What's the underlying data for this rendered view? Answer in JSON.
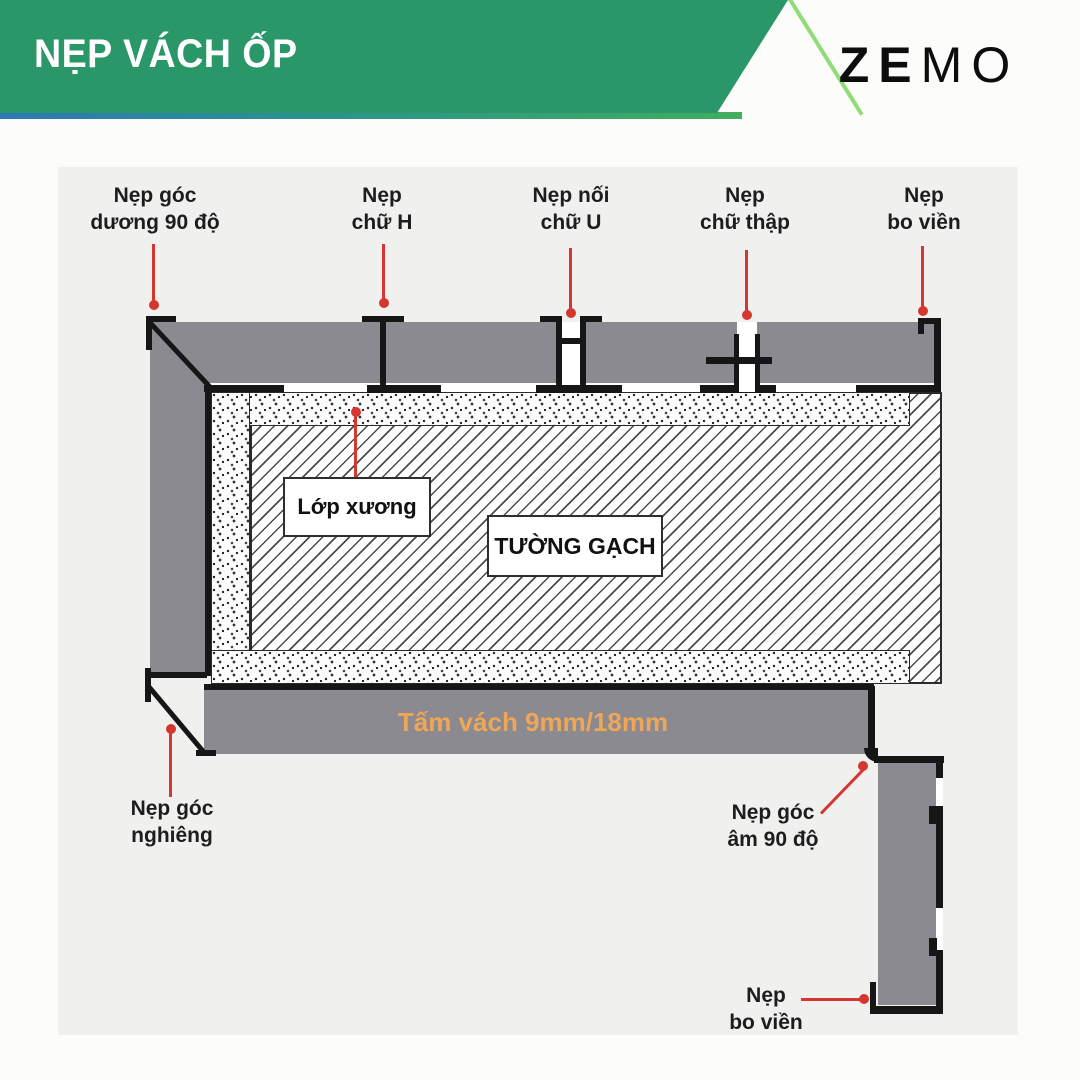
{
  "header": {
    "title": "NẸP VÁCH ỐP",
    "brand_heavy": "ZE",
    "brand_light": "MO"
  },
  "colors": {
    "header_green": "#2a9768",
    "header_edge_light": "#90dd78",
    "underline_gradient": [
      "#2e78b5",
      "#2a948b",
      "#43ad5e"
    ],
    "panel_gray": "#8a8a90",
    "trim_black": "#161616",
    "callout_red": "#d63630",
    "panel_label_orange": "#efa657",
    "diagram_bg": "#f0f0ee"
  },
  "diagram": {
    "callouts_top": [
      {
        "line1": "Nẹp góc",
        "line2": "dương 90 độ"
      },
      {
        "line1": "Nẹp",
        "line2": "chữ H"
      },
      {
        "line1": "Nẹp nối",
        "line2": "chữ U"
      },
      {
        "line1": "Nẹp",
        "line2": "chữ thập"
      },
      {
        "line1": "Nẹp",
        "line2": "bo viền"
      }
    ],
    "frame_label": "Lớp xương",
    "wall_label": "TƯỜNG GẠCH",
    "panel_label": "Tấm vách 9mm/18mm",
    "callout_bottom_left": {
      "line1": "Nẹp góc",
      "line2": "nghiêng"
    },
    "callout_corner": {
      "line1": "Nẹp góc",
      "line2": "âm 90 độ"
    },
    "callout_bottom_right": {
      "line1": "Nẹp",
      "line2": "bo viền"
    }
  }
}
